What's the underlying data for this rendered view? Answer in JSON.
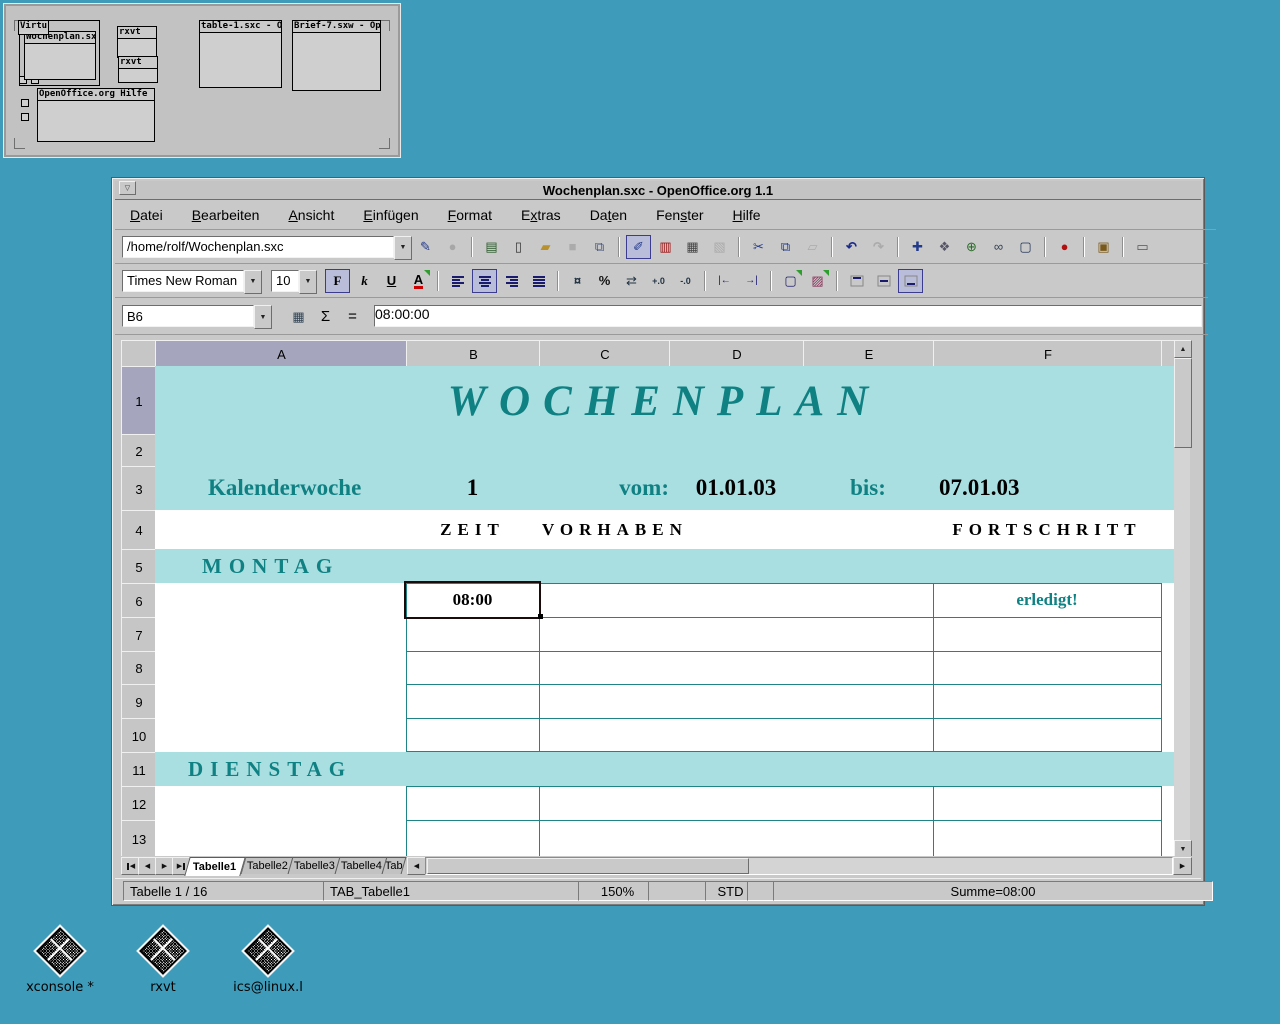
{
  "desktop": {
    "background": "#3f9bba",
    "icons": [
      {
        "label": "xconsole *"
      },
      {
        "label": "rxvt"
      },
      {
        "label": "ics@linux.l"
      }
    ]
  },
  "pager": {
    "label": "Virtu",
    "windows": {
      "wochenplan": "Wochenplan.sx",
      "rxvt_top": "rxvt",
      "rxvt_bottom": "rxvt",
      "table": "table-1.sxc - Op",
      "brief": "Brief-7.sxw - Ope",
      "hilfe": "OpenOffice.org Hilfe -"
    }
  },
  "window": {
    "title": "Wochenplan.sxc - OpenOffice.org 1.1",
    "menu": [
      "Datei",
      "Bearbeiten",
      "Ansicht",
      "Einfügen",
      "Format",
      "Extras",
      "Daten",
      "Fenster",
      "Hilfe"
    ],
    "function_bar": {
      "url": "/home/rolf/Wochenplan.sxc"
    },
    "format_bar": {
      "font_name": "Times New Roman",
      "font_size": "10",
      "bold_label": "F",
      "italic_label": "k",
      "underline_label": "U",
      "font_color_label": "A"
    },
    "formula_bar": {
      "cell_ref": "B6",
      "sum_label": "Σ",
      "equals_label": "=",
      "content": "08:00:00"
    },
    "icons": {
      "window_menu": "▽",
      "dropdown": "▼",
      "up": "▲",
      "down": "▼",
      "left": "◀",
      "right": "▶",
      "edit_stamp": "✎",
      "stop": "●",
      "new_template": "▤",
      "new_doc": "▯",
      "open_folder": "▰",
      "save": "■",
      "save_all": "⧉",
      "edit_file": "✐",
      "export_pdf": "▥",
      "print": "▦",
      "spellcheck": "▧",
      "cut": "✂",
      "copy": "⧉",
      "paste": "▱",
      "undo": "↶",
      "redo": "↷",
      "navigator": "✚",
      "stylist": "❖",
      "gallery_doc": "⊕",
      "hyperlink": "∞",
      "screen": "▢",
      "record": "●",
      "gallery": "▣",
      "datasource": "▭",
      "currency": "¤",
      "percent": "%",
      "standard_format": "⇄",
      "add_decimal": "+.0",
      "del_decimal": "-.0",
      "indent_less": "|←",
      "indent_more": "→|",
      "borders": "▢",
      "background_color": "▨",
      "function_wizard": "▦"
    },
    "sheet": {
      "col_headers": [
        "A",
        "B",
        "C",
        "D",
        "E",
        "F"
      ],
      "row_headers": [
        "1",
        "2",
        "3",
        "4",
        "5",
        "6",
        "7",
        "8",
        "9",
        "10",
        "11",
        "12",
        "13"
      ],
      "cells": {
        "title": "WOCHENPLAN",
        "kalenderwoche_label": "Kalenderwoche",
        "kalenderwoche_value": "1",
        "vom_label": "vom:",
        "vom_value": "01.01.03",
        "bis_label": "bis:",
        "bis_value": "07.01.03",
        "zeit": "ZEIT",
        "vorhaben": "VORHABEN",
        "fortschritt": "FORTSCHRITT",
        "montag": "MONTAG",
        "b6_value": "08:00",
        "erledigt": "erledigt!",
        "dienstag": "DIENSTAG"
      },
      "colors": {
        "band": "#aadfe2",
        "accent_text": "#0f8183",
        "grid_line": "#1e8486",
        "selected_header": "#a5a5bd"
      }
    },
    "tabs": {
      "sheets": [
        "Tabelle1",
        "Tabelle2",
        "Tabelle3",
        "Tabelle4",
        "Tab"
      ]
    },
    "status_bar": {
      "sheet_info": "Tabelle 1 / 16",
      "tab_name": "TAB_Tabelle1",
      "zoom": "150%",
      "mode": "STD",
      "sum": "Summe=08:00"
    }
  }
}
